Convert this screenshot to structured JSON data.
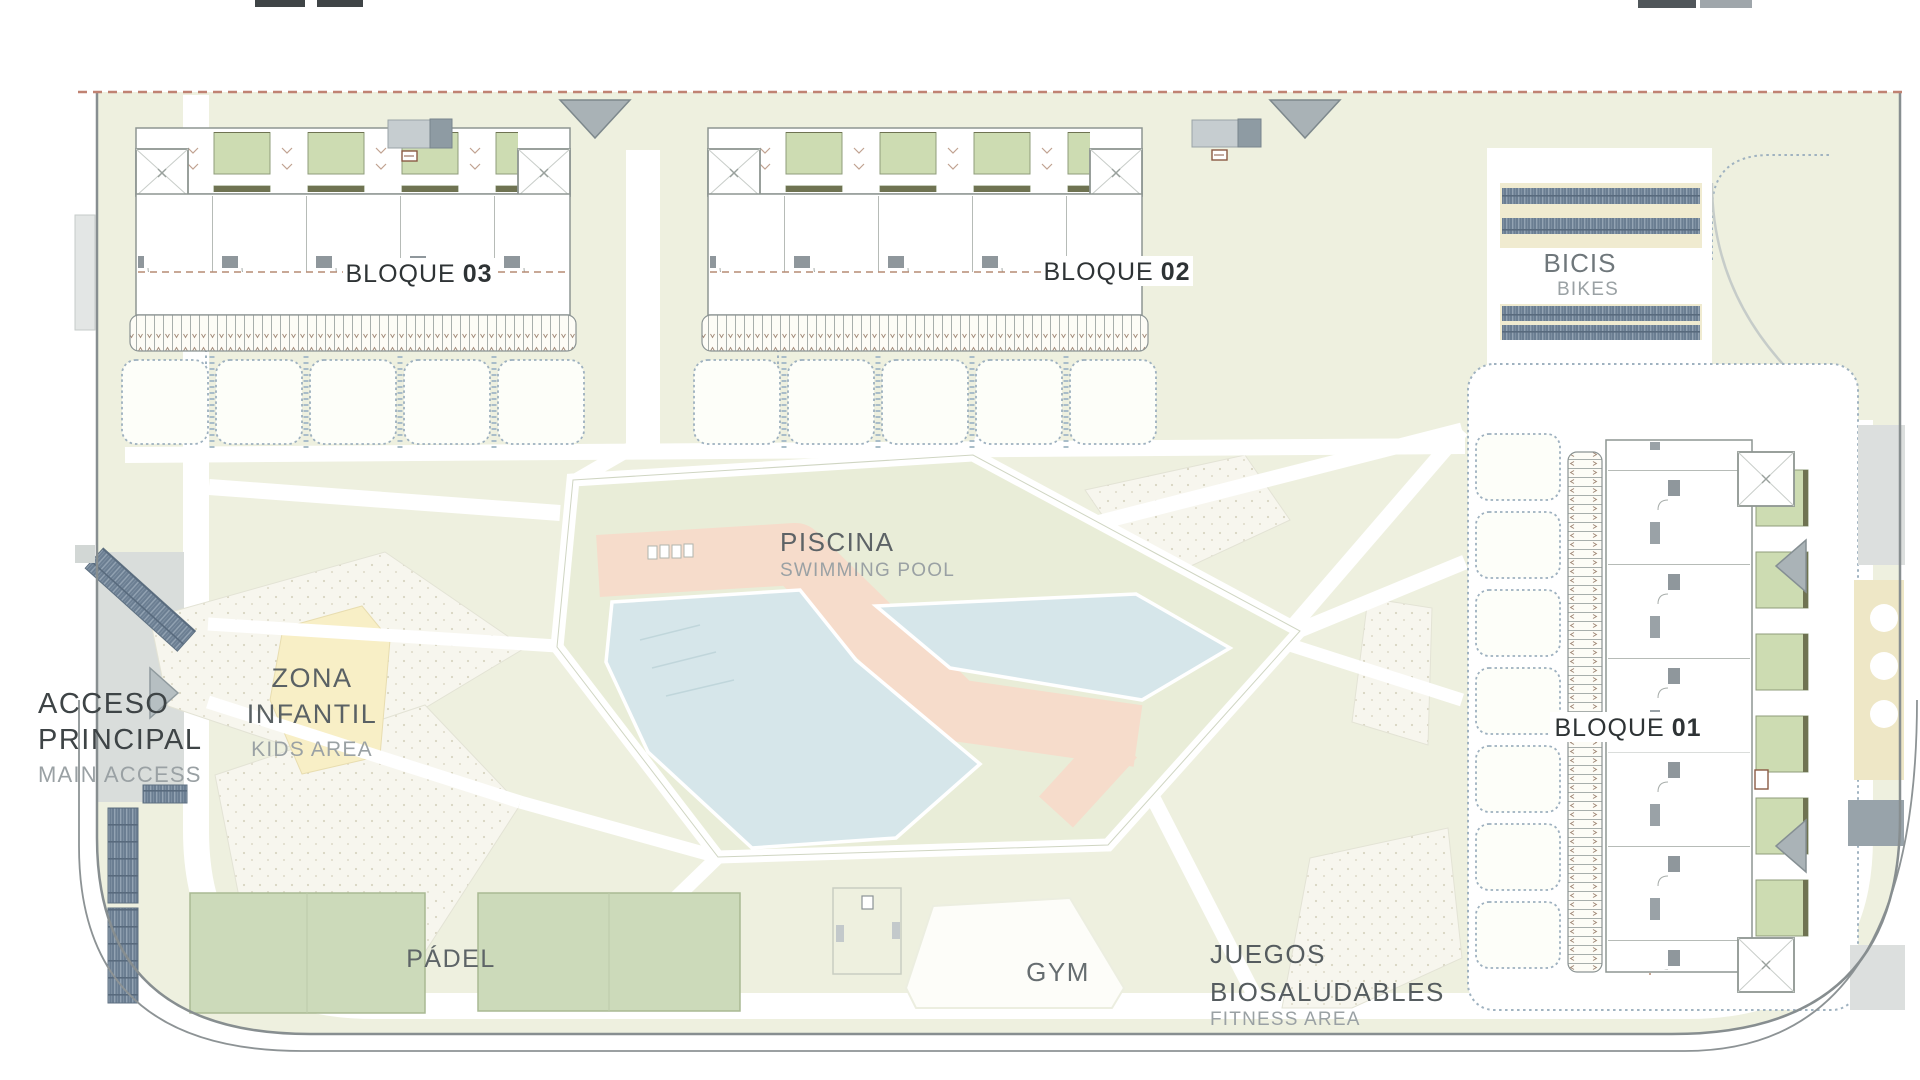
{
  "plan": {
    "type": "residential-site-plan",
    "areas": {
      "bloque03": {
        "label": "BLOQUE",
        "number": "03"
      },
      "bloque02": {
        "label": "BLOQUE",
        "number": "02"
      },
      "bloque01": {
        "label": "BLOQUE",
        "number": "01"
      },
      "bikes": {
        "es": "BICIS",
        "en": "BIKES"
      },
      "pool": {
        "es": "PISCINA",
        "en": "SWIMMING POOL"
      },
      "kids": {
        "es1": "ZONA",
        "es2": "INFANTIL",
        "en": "KIDS AREA"
      },
      "access": {
        "es1": "ACCESO",
        "es2": "PRINCIPAL",
        "en": "MAIN ACCESS"
      },
      "padel": {
        "es": "PÁDEL"
      },
      "gym": {
        "es": "GYM"
      },
      "fitness": {
        "es1": "JUEGOS",
        "es2": "BIOSALUDABLES",
        "en": "FITNESS AREA"
      }
    },
    "colors": {
      "site_green": "#eef0df",
      "pool_garden_green": "#e9edd8",
      "court_green": "#ccdaba",
      "planter_green": "#cddcb2",
      "pool_blue": "#d6e6ea",
      "deck_salmon": "#f6dccb",
      "bike_rack_navy": "#6b7e92",
      "cream": "#f0ebd0",
      "kids_yellow": "#f8efc6",
      "boundary_gray": "#878e90",
      "boundary_dashed_red": "#c08272",
      "label_dark": "#3e4446",
      "label_gray": "#9aa1a4"
    }
  }
}
